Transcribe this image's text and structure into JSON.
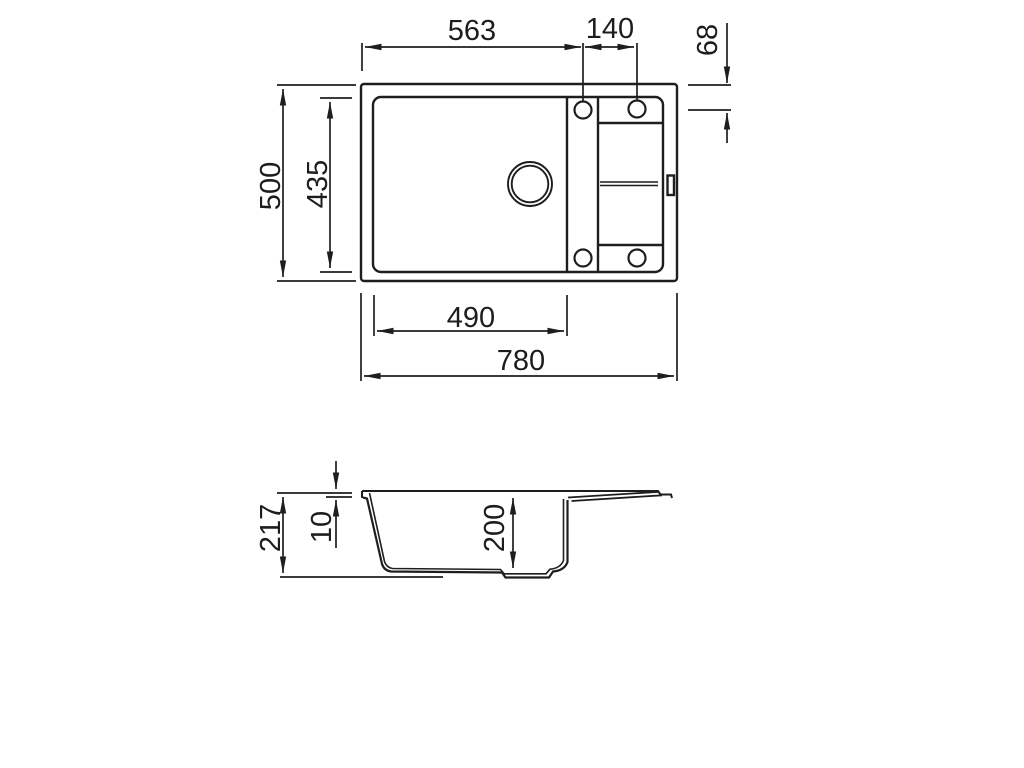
{
  "title": "Kitchen sink dimensional drawing",
  "colors": {
    "line": "#1e1e1e",
    "background": "#ffffff"
  },
  "top_view": {
    "name": "Top view",
    "dims": {
      "tap_offset_x": "563",
      "tap_spacing": "140",
      "tap_offset_y": "68",
      "overall_depth": "500",
      "bowl_depth": "435",
      "bowl_width": "490",
      "overall_width": "780"
    }
  },
  "side_view": {
    "name": "Side section view",
    "dims": {
      "overall_height": "217",
      "rim_height": "10",
      "bowl_depth": "200"
    }
  }
}
